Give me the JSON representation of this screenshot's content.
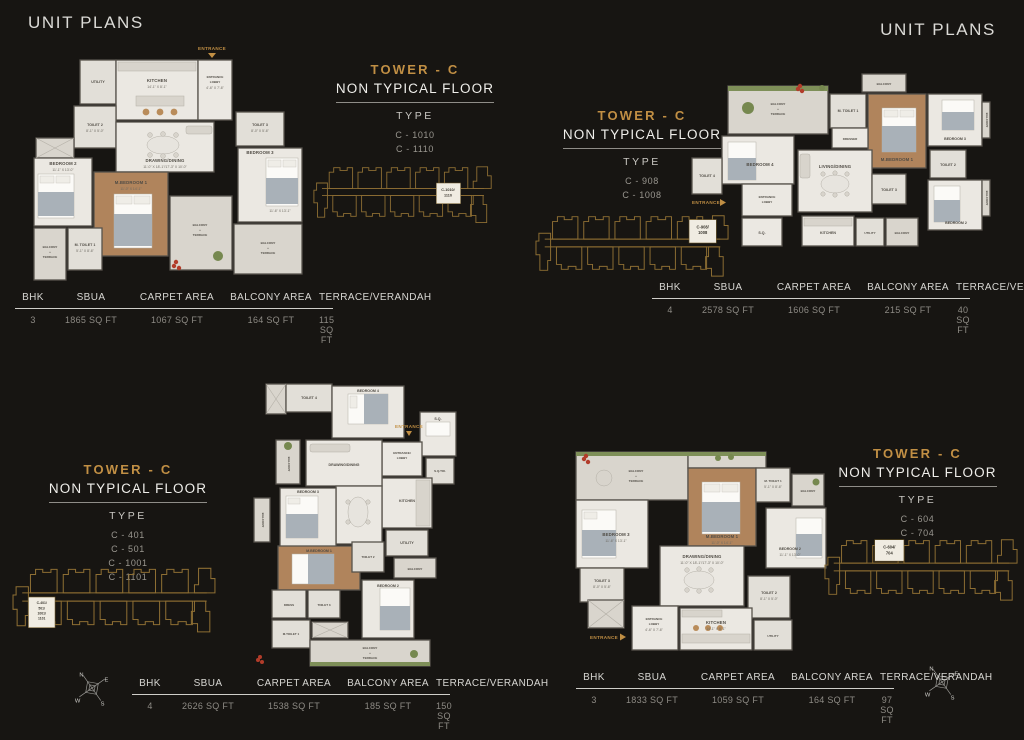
{
  "page": {
    "title_left": "UNIT PLANS",
    "title_right": "UNIT PLANS",
    "accent_gold": "#c18f44",
    "keyplan_gold": "#8d6e33",
    "entrance_label": "ENTRANCE",
    "balcony_label": "BALCONY",
    "terrace_label": "TERRACE",
    "plus": "+",
    "compass": {
      "n": "N",
      "e": "E",
      "s": "S",
      "w": "W"
    }
  },
  "table_headers": [
    "BHK",
    "SBUA",
    "CARPET AREA",
    "BALCONY AREA",
    "TERRACE/VERANDAH"
  ],
  "units": [
    {
      "tower": "TOWER - C",
      "floor": "NON TYPICAL FLOOR",
      "type_label": "TYPE",
      "types": [
        "C - 1010",
        "C - 1110"
      ],
      "keyplan": [
        "C-1010/",
        "1110"
      ],
      "row": [
        "3",
        "1865 SQ FT",
        "1067 SQ FT",
        "164 SQ FT",
        "115 SQ FT"
      ],
      "rooms": {
        "utility": "UTILITY",
        "kitchen": "KITCHEN",
        "kitchen_dim": "14'-1\" X 8'-1\"",
        "lobby1": "ENTRANCE",
        "lobby2": "LOBBY",
        "lobby_dim": "4'-6\" X 7'-6\"",
        "toilet2": "TOILET 2",
        "toilet2_dim": "8'-1\" X 5'-0\"",
        "bedroom2": "BEDROOM 2",
        "bedroom2_dim": "11'-1\" X 13'-0\"",
        "drawing": "DRAWING/DINING",
        "drawing_dim": "11'-0\" X 18'-1\"/17'-3\" X 10'-0\"",
        "mbedroom": "M.BEDROOM 1",
        "mbedroom_dim": "11'-0\" X 14'-1\"",
        "toilet3": "TOILET 3",
        "toilet3_dim": "8'-0\" X 5'-6\"",
        "bedroom3": "BEDROOM 3",
        "bedroom3_dim": "11'-6\" X 13'-1\"",
        "mtoilet1": "M. TOILET 1",
        "mtoilet_dim": "5'-1\" X 8'-6\""
      }
    },
    {
      "tower": "TOWER - C",
      "floor": "NON TYPICAL FLOOR",
      "type_label": "TYPE",
      "types": [
        "C - 908",
        "C - 1008"
      ],
      "keyplan": [
        "C-908/",
        "1008"
      ],
      "row": [
        "4",
        "2578 SQ FT",
        "1606 SQ FT",
        "215 SQ FT",
        "40 SQ FT"
      ],
      "rooms": {
        "bedroom4": "BEDROOM 4",
        "toilet4": "TOILET 4",
        "living": "LIVING/DINING",
        "dresser": "DRESSER",
        "mtoilet1": "M. TOILET 1",
        "mbedroom": "M.BEDROOM 1",
        "bedroom3": "BEDROOM 3",
        "toilet2": "TOILET 2",
        "bedroom2": "BEDROOM 2",
        "toilet3": "TOILET 3",
        "lobby1": "ENTRANCE",
        "lobby2": "LOBBY",
        "sq": "S.Q.",
        "kitchen": "KITCHEN",
        "utility": "UTILITY"
      }
    },
    {
      "tower": "TOWER - C",
      "floor": "NON TYPICAL FLOOR",
      "type_label": "TYPE",
      "types": [
        "C - 401",
        "C - 501",
        "C - 1001",
        "C - 1101"
      ],
      "keyplan": [
        "C-401/",
        "501/",
        "1001/",
        "1101"
      ],
      "row": [
        "4",
        "2626 SQ FT",
        "1538 SQ FT",
        "185 SQ FT",
        "150 SQ FT"
      ],
      "rooms": {
        "toilet4": "TOILET 4",
        "bedroom4": "BEDROOM 4",
        "sq": "S.Q.",
        "lobby1": "ENTRANCE/",
        "lobby2": "LOBBY",
        "sqtoi": "S.Q.TOI.",
        "kitchen": "KITCHEN",
        "drawing": "DRAWING/DINING",
        "bedroom3": "BEDROOM 3",
        "mbedroom": "M.BEDROOM 1",
        "utility": "UTILITY",
        "toilet2": "TOILET 2",
        "bedroom2": "BEDROOM 2",
        "dress": "DRESS",
        "toilet3": "TOILET 3",
        "mtoilet1": "M.TOILET 1"
      }
    },
    {
      "tower": "TOWER - C",
      "floor": "NON TYPICAL FLOOR",
      "type_label": "TYPE",
      "types": [
        "C - 604",
        "C - 704"
      ],
      "keyplan": [
        "C-604/",
        "704"
      ],
      "row": [
        "3",
        "1833 SQ FT",
        "1059 SQ FT",
        "164 SQ FT",
        "97 SQ FT"
      ],
      "rooms": {
        "mbedroom": "M.BEDROOM 1",
        "mbedroom_dim": "11'-0\" X 14'-1\"",
        "mtoilet1": "M. TOILET 1",
        "mtoilet_dim": "5'-1\" X 8'-6\"",
        "bedroom3": "BEDROOM 3",
        "bedroom3_dim": "11'-6\" X 13'-1\"",
        "bedroom2": "BEDROOM 2",
        "bedroom2_dim": "11'-1\" X 13'-0\"",
        "drawing": "DRAWING/DINING",
        "drawing_dim": "11'-0\" X 18'-1\"/17'-3\" X 10'-0\"",
        "toilet3": "TOILET 3",
        "toilet3_dim": "8'-0\" X 5'-6\"",
        "toilet2": "TOILET 2",
        "toilet2_dim": "8'-1\" X 5'-0\"",
        "lobby1": "ENTRANCE",
        "lobby2": "LOBBY",
        "lobby_dim": "4'-6\" X 7'-6\"",
        "kitchen": "KITCHEN",
        "kitchen_dim": "14'-1\" X 8'-1\"",
        "utility": "UTILITY"
      }
    }
  ]
}
